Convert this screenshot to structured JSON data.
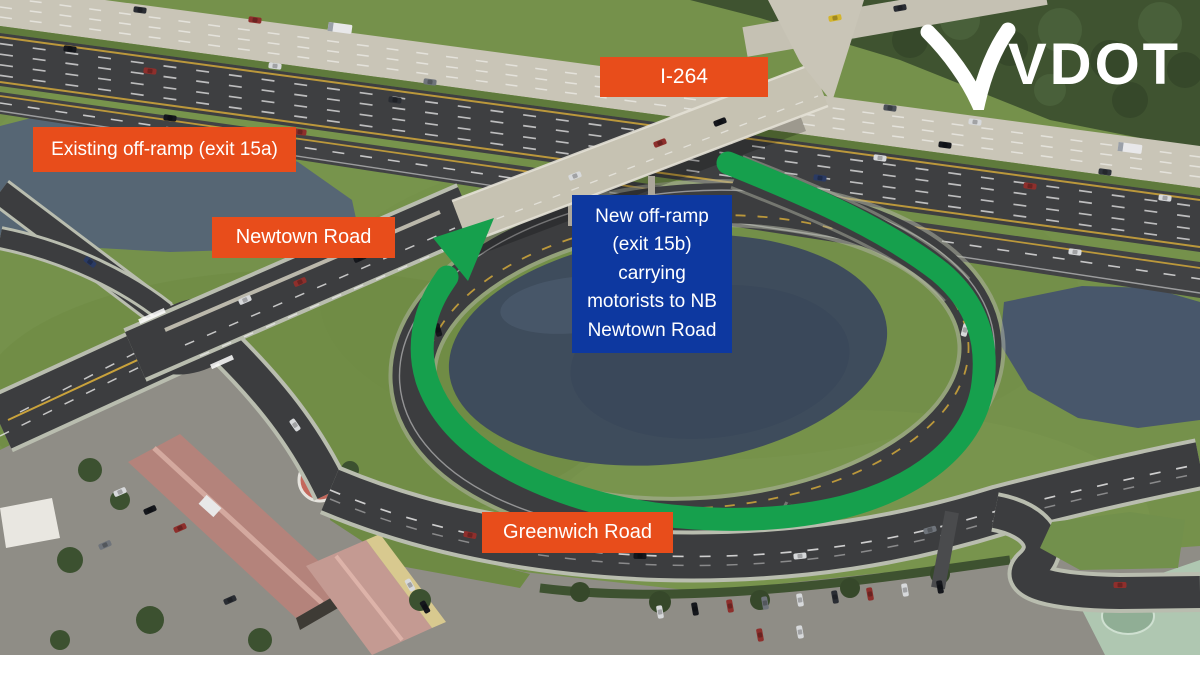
{
  "logo": {
    "text": "VDOT"
  },
  "labels": {
    "i264": {
      "text": "I-264"
    },
    "existing_offramp": {
      "text": "Existing off-ramp (exit 15a)"
    },
    "newtown_road": {
      "text": "Newtown Road"
    },
    "new_offramp": {
      "text": "New off-ramp\n(exit 15b)\ncarrying\nmotorists to NB\nNewtown Road"
    },
    "greenwich_road": {
      "text": "Greenwich Road"
    }
  },
  "colors": {
    "label_orange": "#E84D1B",
    "callout_blue": "#0D38A0",
    "route_arrow_green": "#16A04D",
    "logo_white": "#FFFFFF"
  }
}
